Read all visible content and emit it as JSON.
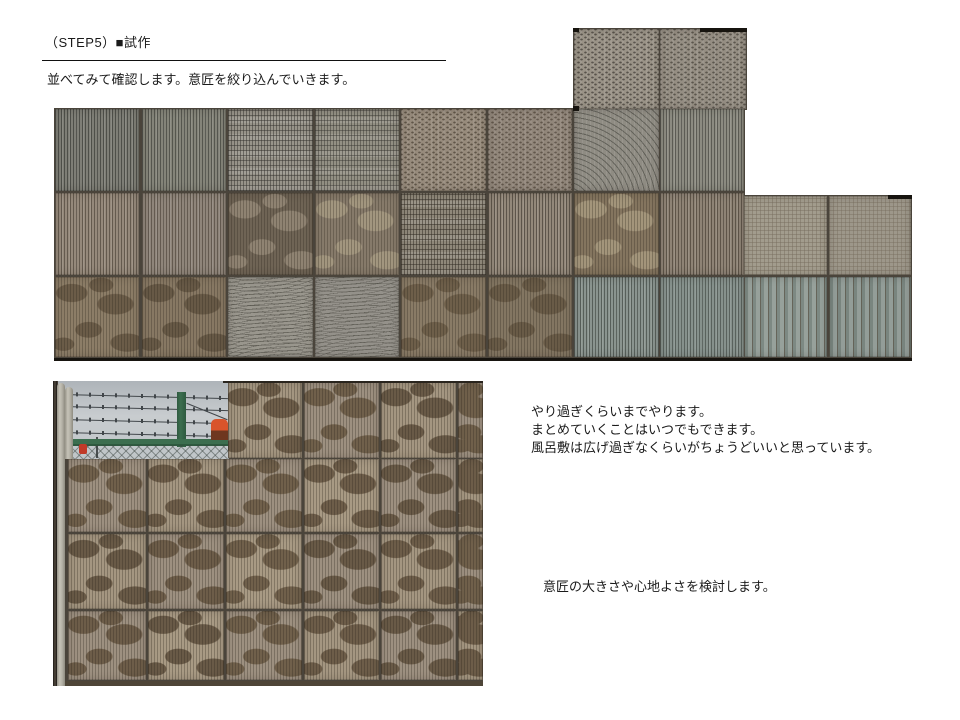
{
  "header": {
    "step_label": "（STEP5）■試作",
    "subtitle": "並べてみて確認します。意匠を絞り込んでいきます。"
  },
  "notes": {
    "approach_lines": [
      "やり過ぎくらいまでやります。",
      "まとめていくことはいつでもできます。",
      "風呂敷は広げ過ぎなくらいがちょうどいいと思っています。"
    ],
    "design_note": "意匠の大きさや心地よさを検討します。"
  },
  "palette": {
    "grout": "#4a443b",
    "sky_top": "#aeb4b9",
    "sky_mid": "#c8cccf",
    "sky_bottom": "#bfc5c8",
    "fence_green": "#3c6e4f",
    "fence_green_dark": "#2e5a3f",
    "mesh_line": "rgba(55,65,60,0.45)",
    "wire": "#41464a",
    "sliver": "#433c33",
    "red": "#c03a28",
    "orange": "#d9542b",
    "orange_dark": "#6e371f",
    "wall_strip": "#4e4537"
  },
  "montage": {
    "blocks": [
      [
        0,
        80,
        691,
        250
      ],
      [
        519,
        0,
        174,
        82
      ],
      [
        689,
        167,
        169,
        163
      ]
    ],
    "tiles": [
      [
        1,
        81,
        84,
        82,
        "vstripe",
        "#7e7e76",
        "rgba(38,40,36,0.55)"
      ],
      [
        88,
        81,
        84,
        82,
        "vstripe",
        "#848479",
        "rgba(38,40,36,0.50)"
      ],
      [
        174,
        81,
        85,
        82,
        "plaid",
        "#98948a",
        "rgba(52,50,46,0.50)"
      ],
      [
        261,
        81,
        84,
        82,
        "plaid",
        "#939084",
        "rgba(52,50,46,0.45)"
      ],
      [
        347,
        81,
        85,
        82,
        "dots",
        "#978b7c",
        "rgba(58,48,36,0.60)"
      ],
      [
        434,
        81,
        84,
        82,
        "dots",
        "#91867a",
        "rgba(58,48,36,0.55)"
      ],
      [
        520,
        81,
        85,
        82,
        "fan",
        "#8f8c83",
        "rgba(58,58,52,0.50)"
      ],
      [
        606,
        81,
        84,
        82,
        "vstripe",
        "#8c8b81",
        "rgba(44,44,40,0.50)"
      ],
      [
        1,
        165,
        84,
        82,
        "vstripe",
        "#95897b",
        "rgba(52,44,34,0.50)"
      ],
      [
        88,
        165,
        84,
        82,
        "vstripe",
        "#8f857a",
        "rgba(52,44,34,0.48)"
      ],
      [
        174,
        165,
        85,
        82,
        "camo",
        "#6f6455",
        "#8f8372"
      ],
      [
        261,
        165,
        84,
        82,
        "camo",
        "#867a6a",
        "#a2967f"
      ],
      [
        347,
        165,
        85,
        82,
        "plaid",
        "#8f887a",
        "rgba(48,42,34,0.50)"
      ],
      [
        434,
        165,
        84,
        82,
        "vstripe",
        "#93887a",
        "rgba(48,42,34,0.55)"
      ],
      [
        520,
        165,
        85,
        82,
        "camo",
        "#84755f",
        "#a3957b"
      ],
      [
        606,
        165,
        84,
        82,
        "vstripe",
        "#8e8375",
        "rgba(46,38,28,0.50)"
      ],
      [
        1,
        249,
        84,
        80,
        "camo",
        "#8c7d67",
        "#6b5c48"
      ],
      [
        88,
        249,
        84,
        80,
        "camo",
        "#877863",
        "#675946"
      ],
      [
        174,
        249,
        85,
        80,
        "waves",
        "#99968d",
        "rgba(66,64,56,0.50)"
      ],
      [
        261,
        249,
        84,
        80,
        "waves",
        "#94918a",
        "rgba(66,64,56,0.46)"
      ],
      [
        347,
        249,
        85,
        80,
        "camo",
        "#897b66",
        "#6e5f4a"
      ],
      [
        434,
        249,
        84,
        80,
        "camo",
        "#837662",
        "#695b47"
      ],
      [
        520,
        249,
        85,
        80,
        "vstripe",
        "#8a948f",
        "rgba(45,52,47,0.55)"
      ],
      [
        606,
        249,
        84,
        80,
        "vstripe",
        "#86918c",
        "rgba(45,52,47,0.50)"
      ],
      [
        520,
        1,
        85,
        80,
        "dots",
        "#9a9387",
        "rgba(52,48,42,0.65)"
      ],
      [
        606,
        1,
        86,
        80,
        "dots",
        "#958e83",
        "rgba(52,48,42,0.60)"
      ],
      [
        690,
        168,
        83,
        79,
        "grid",
        "#a29c8d",
        "rgba(118,108,92,0.45)"
      ],
      [
        775,
        168,
        82,
        79,
        "grid",
        "#9d978a",
        "rgba(118,108,92,0.42)"
      ],
      [
        690,
        249,
        83,
        80,
        "vstripe-wide",
        "#97a19b",
        "#7d8983"
      ],
      [
        775,
        249,
        82,
        80,
        "vstripe-wide",
        "#939d98",
        "#79857f"
      ]
    ],
    "marks": [
      [
        646,
        0,
        47,
        4
      ],
      [
        519,
        0,
        6,
        4
      ],
      [
        519,
        78,
        6,
        5
      ],
      [
        834,
        167,
        24,
        4
      ],
      [
        0,
        330,
        858,
        3
      ]
    ]
  },
  "wall_photo": {
    "tiles": [
      [
        175,
        1,
        74,
        76,
        "camo",
        "#a49681",
        "#6d5d49"
      ],
      [
        251,
        1,
        75,
        76,
        "camo",
        "#9d9080",
        "#70604b"
      ],
      [
        328,
        1,
        75,
        76,
        "camo",
        "#a49681",
        "#695a47"
      ],
      [
        405,
        1,
        25,
        76,
        "camo",
        "#9d9080",
        "#70604b"
      ],
      [
        15,
        78,
        78,
        73,
        "camo",
        "#9d9080",
        "#70604b"
      ],
      [
        95,
        78,
        76,
        73,
        "camo",
        "#a49681",
        "#6d5d49"
      ],
      [
        173,
        78,
        76,
        73,
        "camo",
        "#9d9080",
        "#70604b"
      ],
      [
        251,
        78,
        75,
        73,
        "camo",
        "#a89a84",
        "#6d5d49"
      ],
      [
        328,
        78,
        75,
        73,
        "camo",
        "#9d9080",
        "#695a47"
      ],
      [
        405,
        78,
        25,
        73,
        "camo",
        "#a49681",
        "#6d5d49"
      ],
      [
        15,
        153,
        78,
        75,
        "camo",
        "#a49681",
        "#695a47"
      ],
      [
        95,
        153,
        76,
        75,
        "camo",
        "#9d9080",
        "#6d5d49"
      ],
      [
        173,
        153,
        76,
        75,
        "camo",
        "#a89a84",
        "#70604b"
      ],
      [
        251,
        153,
        75,
        75,
        "camo",
        "#9d9080",
        "#695a47"
      ],
      [
        328,
        153,
        75,
        75,
        "camo",
        "#a49681",
        "#6d5d49"
      ],
      [
        405,
        153,
        25,
        75,
        "camo",
        "#9d9080",
        "#70604b"
      ],
      [
        15,
        230,
        78,
        69,
        "camo",
        "#9d9080",
        "#6d5d49"
      ],
      [
        95,
        230,
        76,
        69,
        "camo",
        "#a89a84",
        "#695a47"
      ],
      [
        173,
        230,
        76,
        69,
        "camo",
        "#9d9080",
        "#70604b"
      ],
      [
        251,
        230,
        75,
        69,
        "camo",
        "#a49681",
        "#6d5d49"
      ],
      [
        328,
        230,
        75,
        69,
        "camo",
        "#9d9080",
        "#695a47"
      ],
      [
        405,
        230,
        25,
        69,
        "camo",
        "#a49681",
        "#6d5d49"
      ]
    ]
  }
}
